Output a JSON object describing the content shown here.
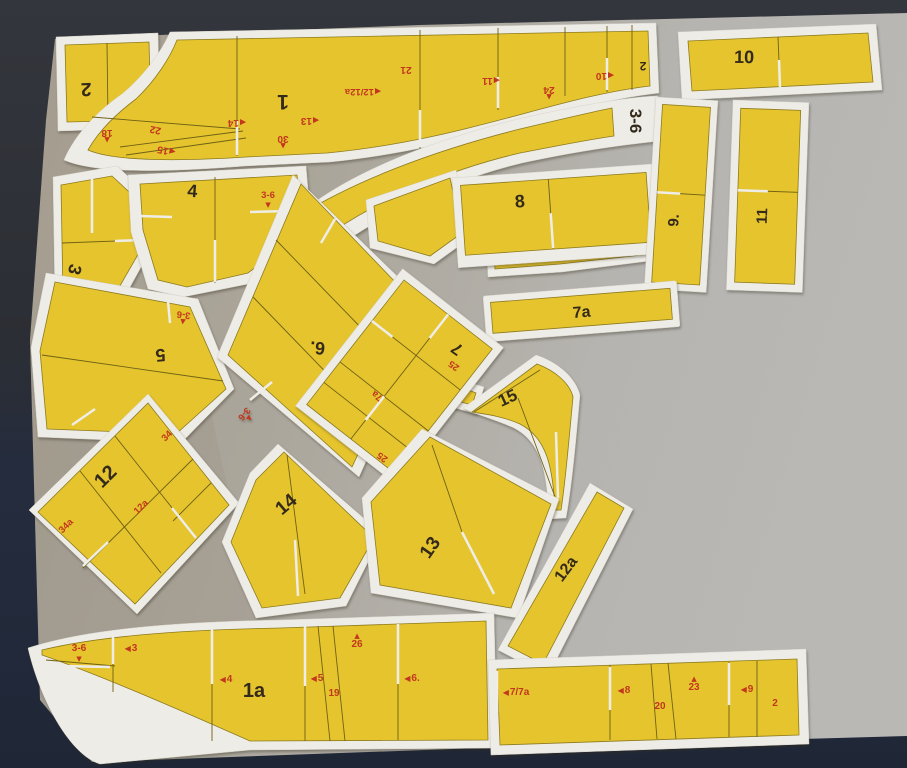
{
  "colors": {
    "background_top": "#2f3238",
    "background_bottom": "#222a3c",
    "cardboard": "#aeaaa0",
    "paper_white": "#eeece6",
    "part_yellow": "#e5c42e",
    "label_black": "#342a1b",
    "label_red": "#c2371d"
  },
  "icons": {
    "arrow_left": "◀",
    "arrow_up": "▲",
    "arrow_down": "▼"
  },
  "pieces": {
    "p1": {
      "label": "1",
      "corner_label": "2",
      "markers": {
        "m18": "18",
        "m22": "22",
        "m15": "15",
        "m14": "14",
        "m30": "30",
        "m13": "13",
        "m12_12a": "12/12a",
        "m21": "21",
        "m11": "11",
        "m24": "24",
        "m10": "10"
      }
    },
    "p2": {
      "label": "2"
    },
    "p3": {
      "label": "3",
      "marker": "3-6"
    },
    "p4": {
      "label": "4",
      "marker": "3-6"
    },
    "p5": {
      "label": "5",
      "marker": "3-6"
    },
    "p6": {
      "label": "6.",
      "marker": "3-6"
    },
    "p7": {
      "label": "7",
      "markers": {
        "m25_top": "25",
        "m7a": "7a",
        "m25_bottom": "25"
      }
    },
    "p8": {
      "label": "8"
    },
    "p9": {
      "label": "9."
    },
    "p10": {
      "label": "10"
    },
    "p11": {
      "label": "11"
    },
    "p36": {
      "label": "3-6"
    },
    "p7a": {
      "label": "7a"
    },
    "p12": {
      "label": "12",
      "markers": {
        "m34": "34",
        "m12a": "12a",
        "m34a": "34a"
      }
    },
    "p12a": {
      "label": "12a"
    },
    "p13": {
      "label": "13"
    },
    "p14": {
      "label": "14"
    },
    "p15": {
      "label": "15"
    },
    "p1a": {
      "label": "1a",
      "markers": {
        "m36": "3-6",
        "m3": "3",
        "m4": "4",
        "m5": "5",
        "m19": "19",
        "m26": "26",
        "m6": "6."
      }
    },
    "strip": {
      "markers": {
        "m77a": "7/7a",
        "m8": "8",
        "m20": "20",
        "m23": "23",
        "m9": "9",
        "m2": "2"
      }
    }
  }
}
